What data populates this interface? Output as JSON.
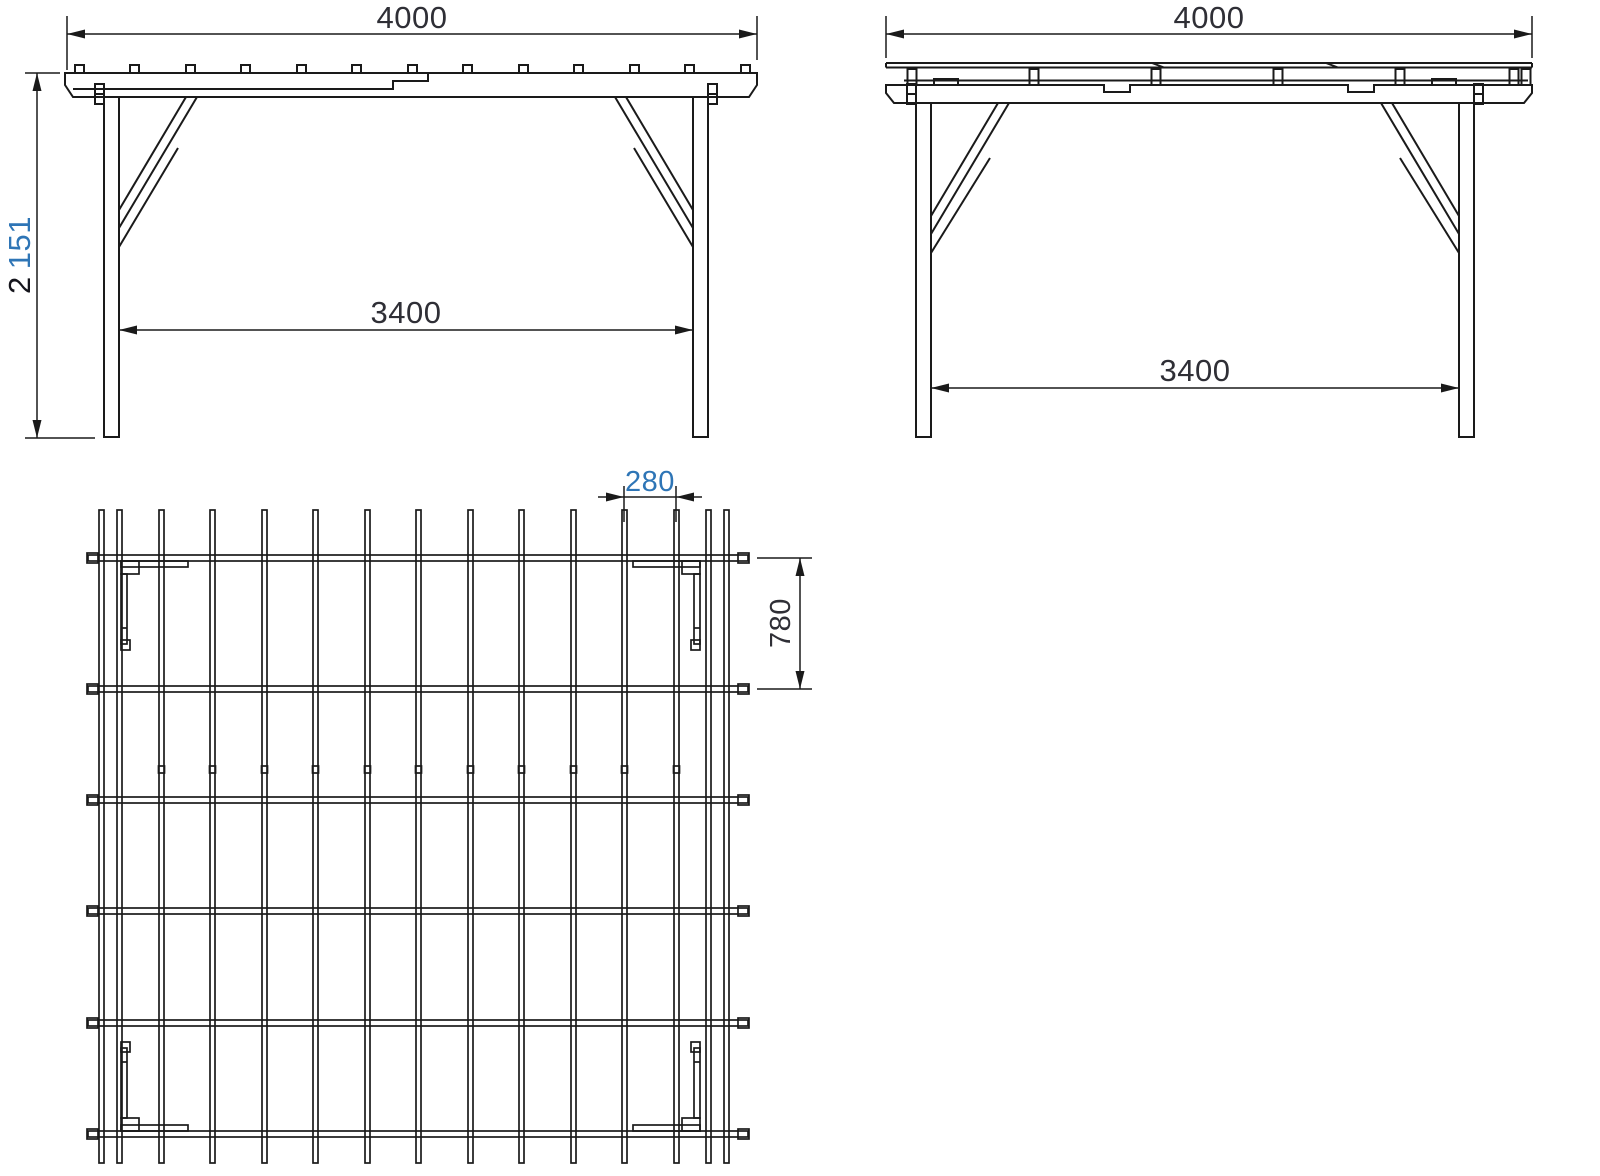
{
  "colors": {
    "line": "#1a1a1a",
    "dim_text": "#2f2f36",
    "dim_text_dark": "#15151c",
    "dim_text_blue": "#2e75b6"
  },
  "views": {
    "front_elevation": {
      "dim_overall_width": "4000",
      "dim_clear_span": "3400",
      "dim_height_group1": "2",
      "dim_height_group2": "151"
    },
    "side_elevation": {
      "dim_overall_width": "4000",
      "dim_clear_span": "3400"
    },
    "roof_plan": {
      "dim_rafter_spacing": "280",
      "dim_bay_depth": "780"
    }
  }
}
